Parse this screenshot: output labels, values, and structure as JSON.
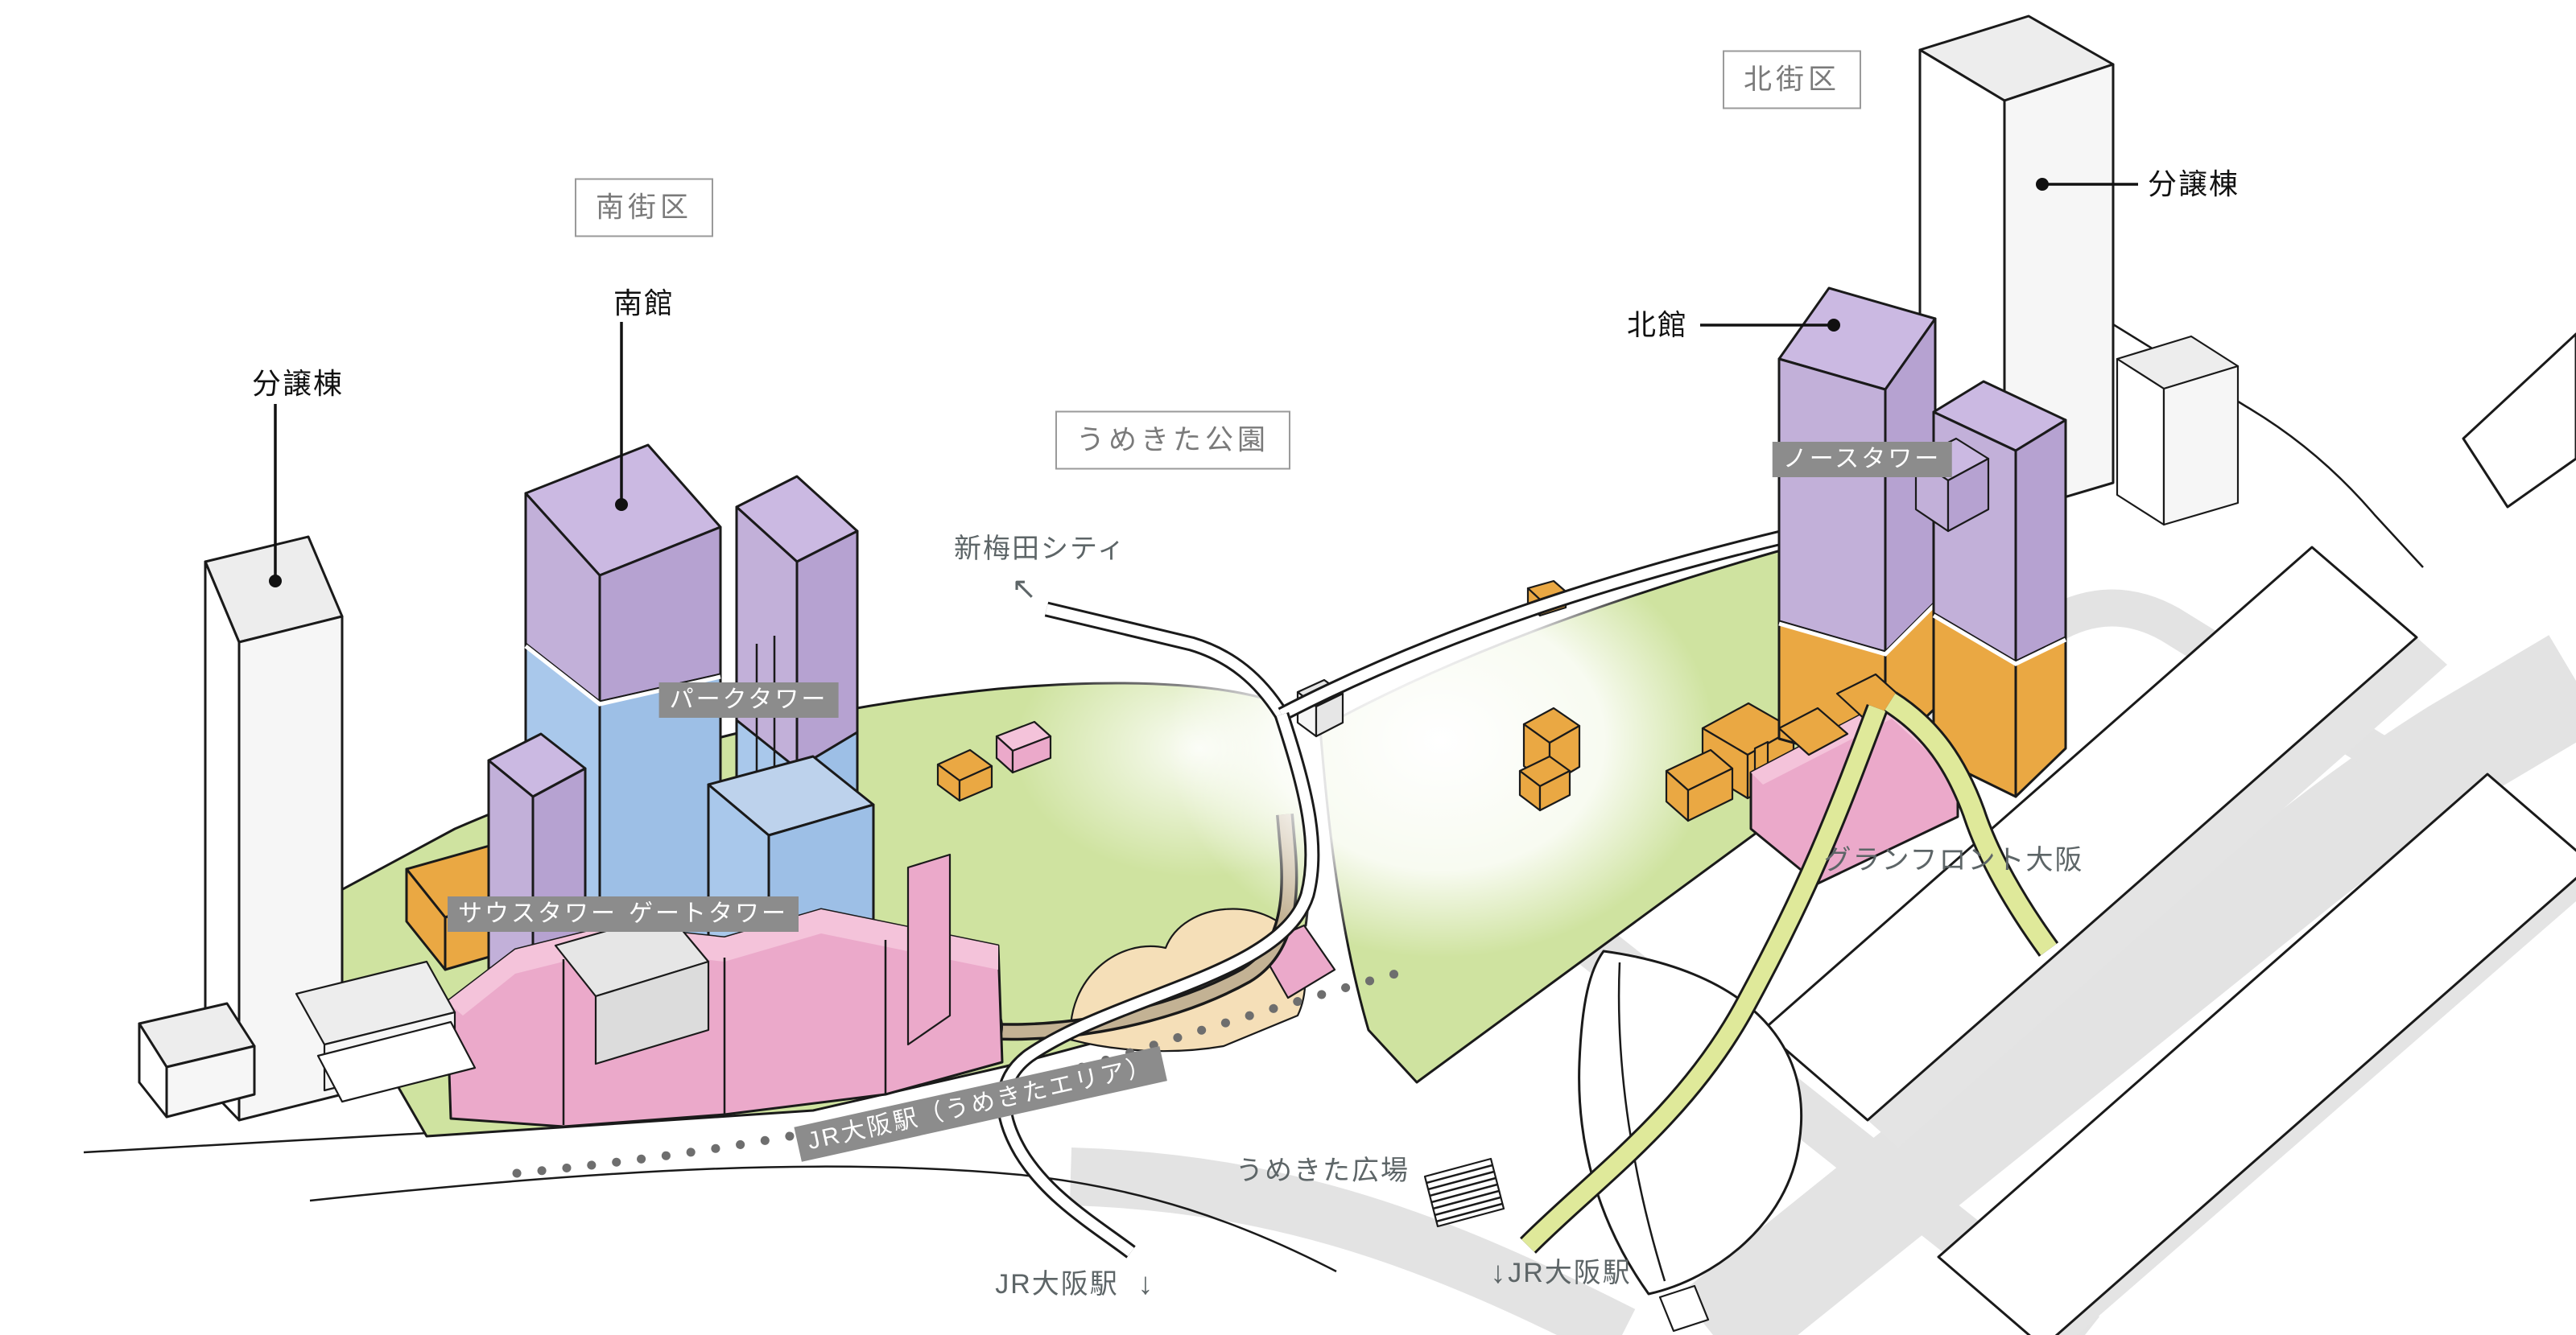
{
  "title": "うめきた2期地区（グラングリーン大阪）開発エリア 鳥瞰図",
  "colors": {
    "purple_top": "#cbb9e2",
    "purple": "#c2b0d9",
    "purple_dark": "#b6a2d1",
    "blue": "#a9c8eb",
    "blue_dark": "#9dbfe6",
    "blue_top": "#bdd2ec",
    "pink": "#eba9ca",
    "pink_light": "#f4c3da",
    "orange": "#eaa843",
    "green": "#cfe3a0",
    "yellow_path": "#dfe99a",
    "road_grey": "#e3e3e3",
    "tan": "#c3b294",
    "sand": "#f5dfb8",
    "badge_grey": "#8c8c8c",
    "box_border": "#9a9a9a",
    "box_text": "#7a7a7a",
    "text_grey": "#5d6567",
    "outline": "#1a1a1a"
  },
  "labels": {
    "south_block": "南街区",
    "north_block": "北街区",
    "umekita_park": "うめきた公園",
    "south_bldg": "南館",
    "north_bldg": "北館",
    "condo_left": "分譲棟",
    "condo_right": "分譲棟",
    "park_tower": "パークタワー",
    "south_tower": "サウスタワー",
    "gate_tower": "ゲートタワー",
    "north_tower": "ノースタワー",
    "jr_umekita": "JR大阪駅（うめきたエリア）",
    "shin_umeda": "新梅田シティ",
    "shin_umeda_arrow": "↖",
    "grand_front": "グランフロント大阪",
    "umekita_plaza": "うめきた広場",
    "jr_osaka_left": "JR大阪駅",
    "jr_osaka_left_arrow": "↓",
    "jr_osaka_right": "JR大阪駅",
    "jr_osaka_right_arrow": "↓"
  }
}
